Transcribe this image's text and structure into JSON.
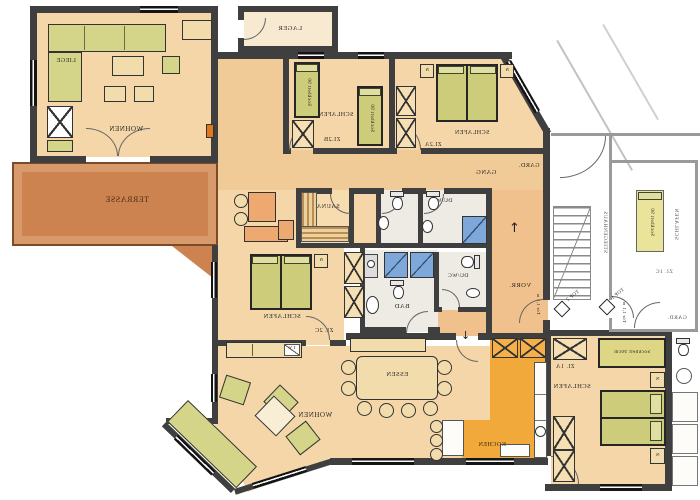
{
  "plan_type": "mirrored apartment floor plan",
  "colors": {
    "floor": "#f4d6a8",
    "corridor": "#f1cb97",
    "terrace": "#cd8350",
    "kitchen": "#f2a93c",
    "bath_floor": "#edebe3",
    "bed_green": "#cdcc7a",
    "sofa_green": "#d5d589",
    "salmon": "#eda96f",
    "shower_blue": "#7da8d9",
    "wall_dark": "#3f3f3f",
    "neighbor_wall": "#9a9a9a"
  },
  "labels": {
    "lager": "LAGER",
    "wohnen": "WOHNEN",
    "liege": "LIEGE",
    "terrasse": "TERRASSE",
    "schlafen": "SCHLAFEN",
    "zi_2b": "ZI.2B",
    "zi_2a": "ZI.2A",
    "zi_2c": "ZI. 2C",
    "zi_1a": "ZI. 1A",
    "zi_1c": "ZI. 1C",
    "gard": "GARD.",
    "gang": "GANG",
    "sauna": "SAUNA",
    "du_wc": "DU/WC",
    "bad": "BAD",
    "vorr": "VORR.",
    "tuer_note": "Tür 1,1 m",
    "top2": "TOP 2",
    "top1": "TOP 1",
    "stiegenhaus": "STIEGENHAUS",
    "tv": "TV",
    "essen": "ESSEN",
    "kochen": "KOCHEN",
    "sockbett90": "Sockbett 90",
    "sockbett90cm": "Sockbett 90cm",
    "n": "N"
  }
}
